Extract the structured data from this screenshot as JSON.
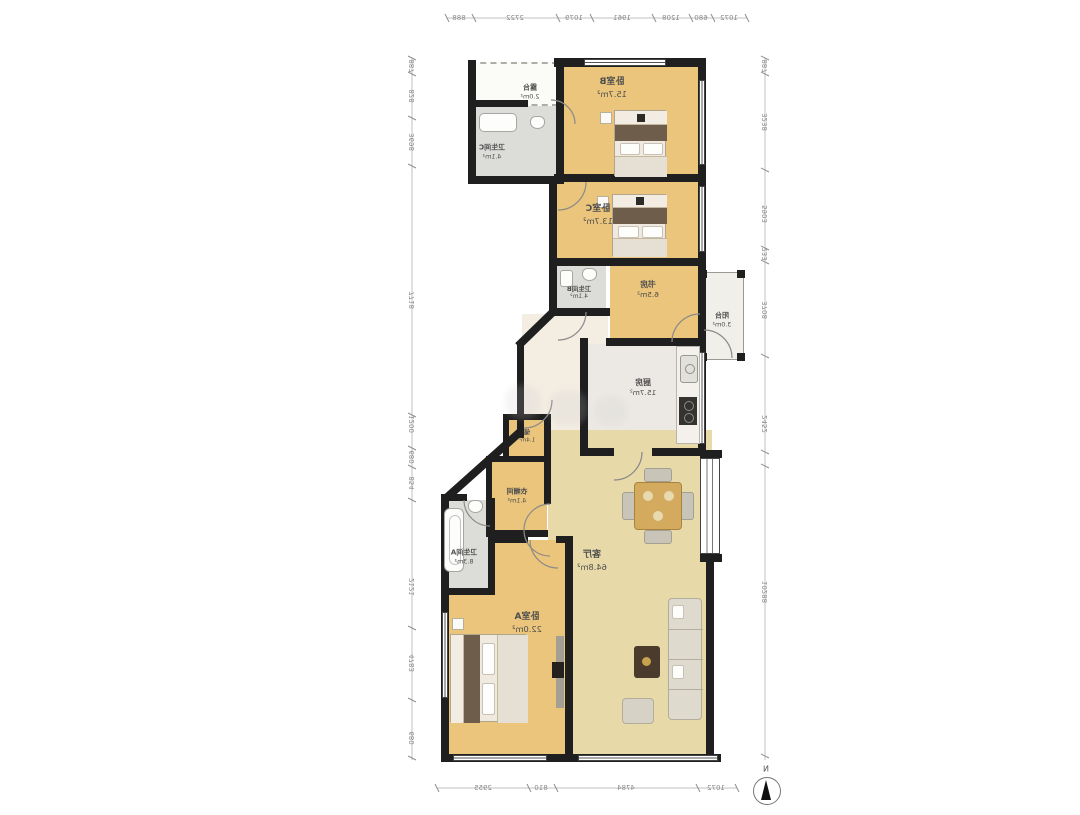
{
  "rooms": {
    "terrace": {
      "name": "露台",
      "area": "2.0m²"
    },
    "bathC": {
      "name": "卫生间C",
      "area": "4.1m²"
    },
    "bedB": {
      "name": "卧室B",
      "area": "15.7m²"
    },
    "bedC": {
      "name": "卧室C",
      "area": "13.7m²"
    },
    "bathB": {
      "name": "卫生间B",
      "area": "4.1m²"
    },
    "study": {
      "name": "书房",
      "area": "6.5m²"
    },
    "balcony": {
      "name": "阳台",
      "area": "3.0m²"
    },
    "kitchen": {
      "name": "厨房",
      "area": "15.7m²"
    },
    "storage": {
      "name": "储",
      "area": "1.4m²"
    },
    "closet": {
      "name": "衣帽间",
      "area": "4.1m²"
    },
    "bathA": {
      "name": "卫生间A",
      "area": "8.3m²"
    },
    "bedA": {
      "name": "卧室A",
      "area": "22.0m²"
    },
    "living": {
      "name": "客厅",
      "area": "64.8m²"
    }
  },
  "dimensions": {
    "top": [
      "888",
      "2722",
      "1079",
      "1961",
      "1208",
      "680",
      "1072"
    ],
    "bottom": [
      "2955",
      "810",
      "4784",
      "1072"
    ],
    "left": [
      "887",
      "828",
      "3698",
      "7718",
      "1200",
      "680",
      "854",
      "2121",
      "4783",
      "680"
    ],
    "right": [
      "887",
      "3238",
      "5903",
      "233",
      "3708",
      "2452",
      "10288"
    ]
  },
  "compass": {
    "label": "N"
  },
  "colors": {
    "wood": "#eac57b",
    "living_floor": "#e7d9a8",
    "bath_floor": "#dcdcd9",
    "kitchen_floor": "#ece9e4",
    "wall": "#1f1f1f",
    "dim_text": "#8b8b8b"
  }
}
